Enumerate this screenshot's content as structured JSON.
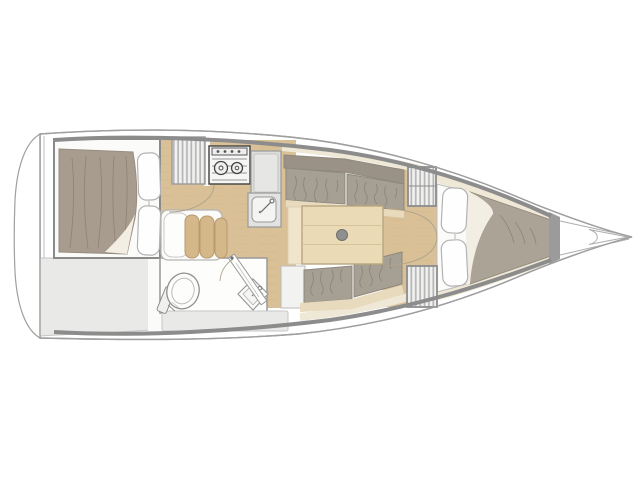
{
  "plan": {
    "type": "sailboat-interior-floor-plan",
    "orientation": "bow-right",
    "rooms": [
      {
        "name": "aft-cabin",
        "items": [
          "double-berth",
          "blanket",
          "pillow",
          "pillow"
        ]
      },
      {
        "name": "cockpit-storage",
        "items": [
          "storage-area"
        ]
      },
      {
        "name": "galley",
        "items": [
          "companionway-steps",
          "two-burner-stove",
          "counter",
          "sink"
        ]
      },
      {
        "name": "head",
        "items": [
          "toilet",
          "wash-basin",
          "door",
          "bench"
        ]
      },
      {
        "name": "salon",
        "items": [
          "settee-port",
          "settee-starboard",
          "table",
          "mast-post",
          "vanity-seat"
        ]
      },
      {
        "name": "forward-bulkhead",
        "items": [
          "locker-top",
          "locker-bottom",
          "double-door"
        ]
      },
      {
        "name": "v-berth",
        "items": [
          "mattress",
          "pillow",
          "pillow",
          "blanket",
          "chain-locker"
        ]
      },
      {
        "name": "bow",
        "items": [
          "stem-fitting"
        ]
      }
    ]
  },
  "colors": {
    "hull_fill": "#ffffff",
    "hull_outline": "#9f9f9f",
    "inner_wall": "#8c8c8c",
    "area_gray": "#e9e9e8",
    "area_gray_border": "#c6c6c6",
    "white_soft": "#fbfbfa",
    "wood_floor": "#d9c097",
    "wood_grain": "#d0b689",
    "stripe_bg": "#f1f1f0",
    "stripe_line": "#b5b5b5",
    "trim_beige": "#e7dabd",
    "lining_cream": "#f0e8d6",
    "cushion_gray": "#a69f93",
    "cushion_gray_dark": "#9a9287",
    "cushion_border": "#8f887c",
    "cushion_shadow": "#857d71",
    "blanket_taupe": "#a89c8f",
    "blanket_taupe_bow": "#aba396",
    "blanket_border": "#968d80",
    "fold_cream": "#f3eee4",
    "pillow_white": "#fefefe",
    "pillow_border": "#b3b3b3",
    "seat_tan": "#d4b88a",
    "seat_tan_border": "#b89a6e",
    "fixture_gray": "#e2e2e1",
    "fixture_inner": "#f4f4f3",
    "fixture_border": "#9a9a9a",
    "stove_line": "#4a4a4a",
    "door_arc": "#b0a58d",
    "table_wood": "#eadab5",
    "table_line": "#d8c49a",
    "table_border": "#b9a67e",
    "bulkhead_gray": "#9b9b9b",
    "thin_line": "#aeaeae"
  }
}
